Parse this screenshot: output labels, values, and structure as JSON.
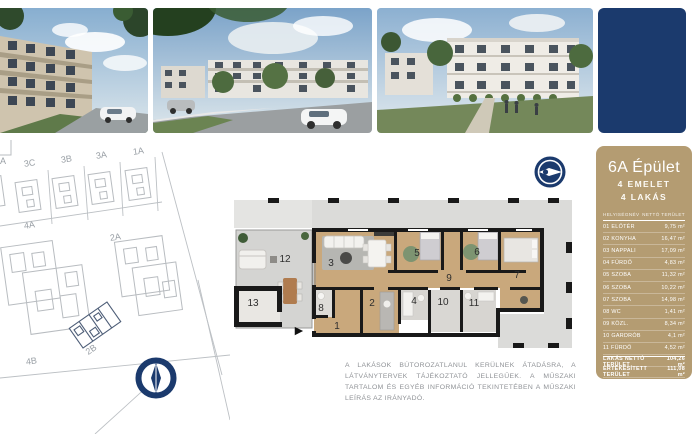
{
  "colors": {
    "navy": "#1b3a6d",
    "sidebar_tan": "#b49c72",
    "wood_floor": "#c9a87c",
    "tile_grey": "#dbdbd9",
    "wall_black": "#191919",
    "disclaimer_grey": "#8f9296"
  },
  "sidebar": {
    "title": "6A Épület",
    "subtitle1": "4 EMELET",
    "subtitle2": "4 LAKÁS",
    "table": {
      "col_room": "HELYISÉGNÉV",
      "col_area": "NETTÓ TERÜLET",
      "rows": [
        {
          "label": "01 ELŐTÉR",
          "value": "9,75 m²"
        },
        {
          "label": "02 KONYHA",
          "value": "16,47 m²"
        },
        {
          "label": "03 NAPPALI",
          "value": "17,09 m²"
        },
        {
          "label": "04 FÜRDŐ",
          "value": "4,83 m²"
        },
        {
          "label": "05 SZOBA",
          "value": "11,32 m²"
        },
        {
          "label": "06 SZOBA",
          "value": "10,22 m²"
        },
        {
          "label": "07 SZOBA",
          "value": "14,98 m²"
        },
        {
          "label": "08 WC",
          "value": "1,41 m²"
        },
        {
          "label": "09 KÖZL.",
          "value": "8,34 m²"
        },
        {
          "label": "10 GARDRÓB",
          "value": "4,1 m²"
        },
        {
          "label": "11 FÜRDŐ",
          "value": "4,52 m²"
        }
      ],
      "summary": [
        {
          "label": "LAKÁS NETTÓ TERÜLET",
          "value": "104,26 m²"
        },
        {
          "label": "ÉRTÉKESÍTETT TERÜLET",
          "value": "111,08 m²"
        },
        {
          "label": "12 TETŐTERASZ",
          "value": "24,62 m²"
        },
        {
          "label": "13 TÁROLÓ",
          "value": "3,85 m²"
        }
      ]
    }
  },
  "site_plan": {
    "labels": [
      {
        "text": "A"
      },
      {
        "text": "3C"
      },
      {
        "text": "3B"
      },
      {
        "text": "3A"
      },
      {
        "text": "1A"
      },
      {
        "text": "4A"
      },
      {
        "text": "2A"
      },
      {
        "text": "2B"
      },
      {
        "text": "4B"
      }
    ]
  },
  "floor_plan": {
    "rooms": [
      {
        "num": "1"
      },
      {
        "num": "2"
      },
      {
        "num": "3"
      },
      {
        "num": "4"
      },
      {
        "num": "5"
      },
      {
        "num": "6"
      },
      {
        "num": "7"
      },
      {
        "num": "8"
      },
      {
        "num": "9"
      },
      {
        "num": "10"
      },
      {
        "num": "11"
      },
      {
        "num": "12"
      },
      {
        "num": "13"
      }
    ]
  },
  "icons": {
    "entrance_arrow": "►",
    "north_compass": "compass needle pointing up",
    "view_direction": "view direction needle pointing right"
  },
  "disclaimer": {
    "text": "A LAKÁSOK BÚTOROZATLANUL KERÜLNEK ÁTADÁSRA, A LÁTVÁNYTERVEK TÁJÉKOZTATÓ JELLEGŰEK. A MŰSZAKI TARTALOM ÉS EGYÉB INFORMÁCIÓ TEKINTETÉBEN A MŰSZAKI LEÍRÁS AZ IRÁNYADÓ."
  }
}
